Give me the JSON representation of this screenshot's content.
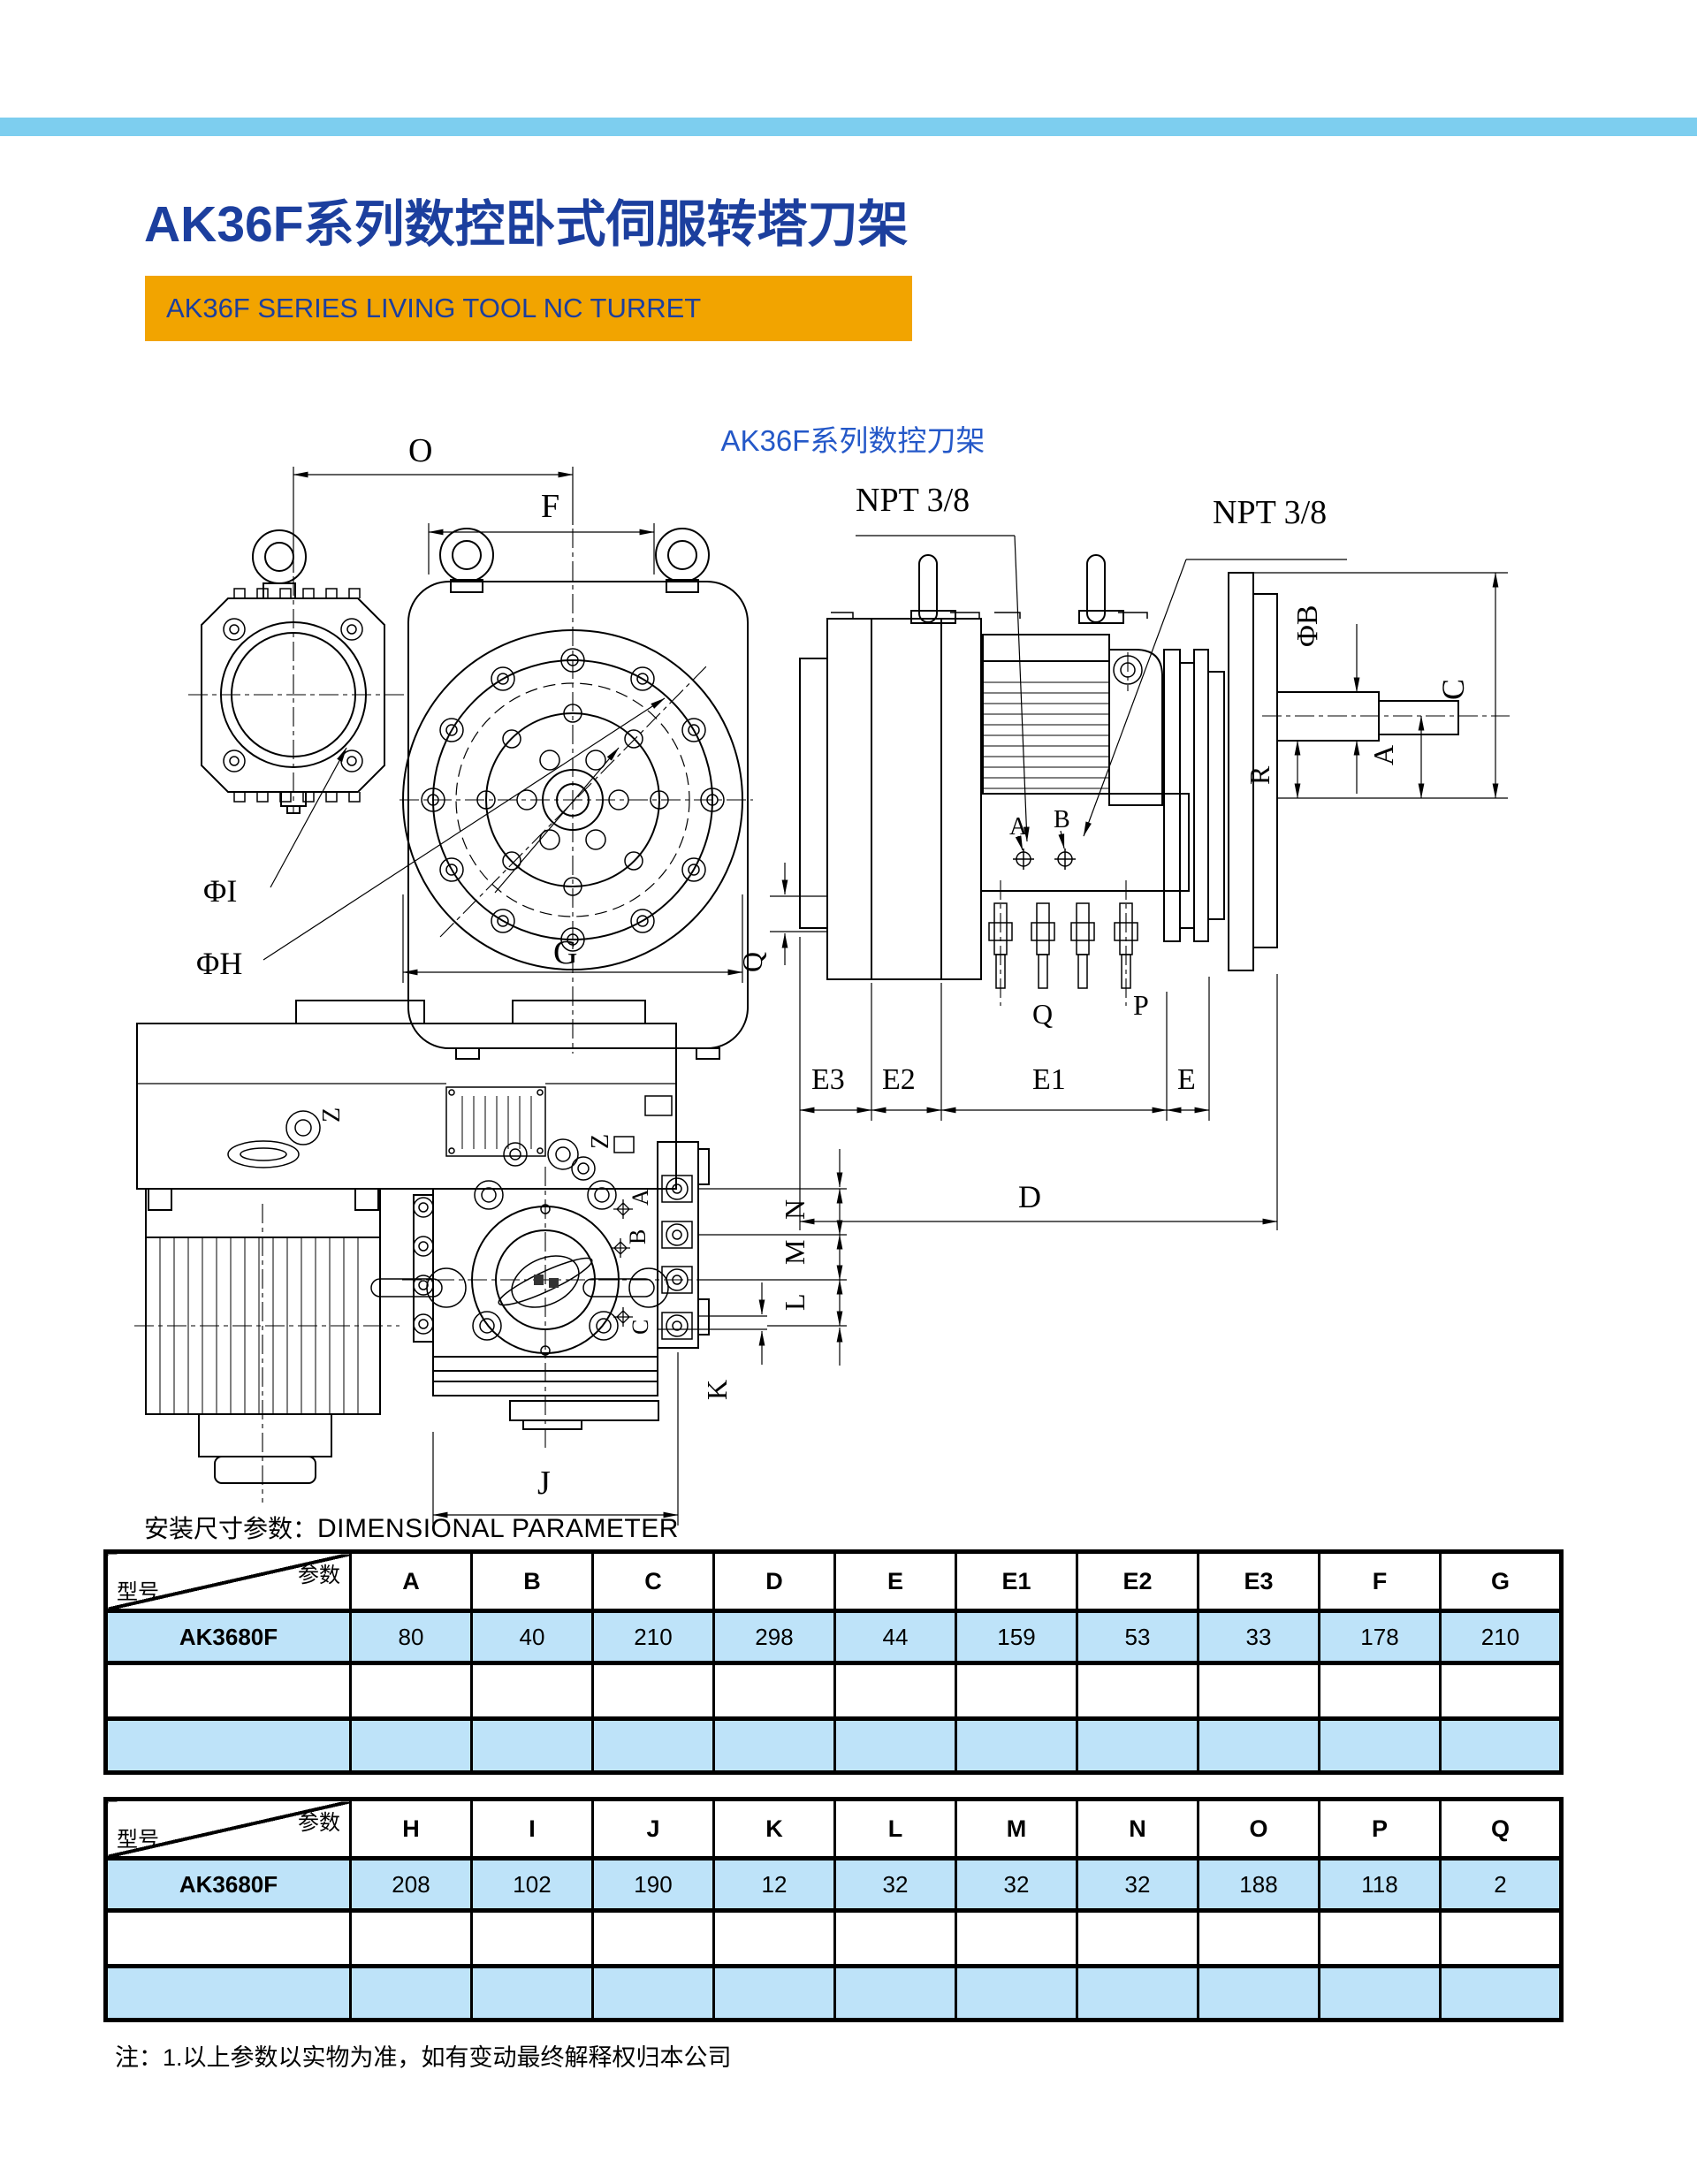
{
  "header": {
    "title": "AK36F系列数控卧式伺服转塔刀架",
    "banner": "AK36F SERIES LIVING TOOL NC TURRET"
  },
  "drawing": {
    "title": "AK36F系列数控刀架",
    "front_view": {
      "labels": {
        "o": "O",
        "f": "F",
        "g": "G",
        "phi_i": "ΦI",
        "phi_h": "ΦH"
      }
    },
    "side_view": {
      "labels": {
        "npt_left": "NPT 3/8",
        "npt_right": "NPT 3/8",
        "phi_b": "ΦB",
        "c": "C",
        "a_vert": "A",
        "r": "R",
        "port_a": "A",
        "port_b": "B",
        "q_side": "Q",
        "q_stud": "Q",
        "p": "P",
        "e3": "E3",
        "e2": "E2",
        "e1": "E1",
        "e": "E",
        "d": "D"
      }
    },
    "plan_view": {
      "labels": {
        "z_upper": "Z",
        "z_lower": "Z",
        "station_a": "A",
        "station_b": "B",
        "station_c": "C",
        "n": "N",
        "m": "M",
        "l": "L",
        "k": "K",
        "j": "J"
      }
    }
  },
  "section": {
    "heading_zh": "安装尺寸参数：",
    "heading_en": "DIMENSIONAL PARAMETER"
  },
  "table1": {
    "corner_top": "参数",
    "corner_bottom": "型号",
    "columns": [
      "A",
      "B",
      "C",
      "D",
      "E",
      "E1",
      "E2",
      "E3",
      "F",
      "G"
    ],
    "model": "AK3680F",
    "values": [
      "80",
      "40",
      "210",
      "298",
      "44",
      "159",
      "53",
      "33",
      "178",
      "210"
    ]
  },
  "table2": {
    "corner_top": "参数",
    "corner_bottom": "型号",
    "columns": [
      "H",
      "I",
      "J",
      "K",
      "L",
      "M",
      "N",
      "O",
      "P",
      "Q"
    ],
    "model": "AK3680F",
    "values": [
      "208",
      "102",
      "190",
      "12",
      "32",
      "32",
      "32",
      "188",
      "118",
      "2"
    ]
  },
  "note": "注：1.以上参数以实物为准，如有变动最终解释权归本公司",
  "colors": {
    "accent_bar": "#7DCEEF",
    "banner_bg": "#F2A400",
    "title_blue": "#1C3F9E",
    "drawing_title_blue": "#2458C8",
    "row_highlight": "#BEE3F9"
  }
}
